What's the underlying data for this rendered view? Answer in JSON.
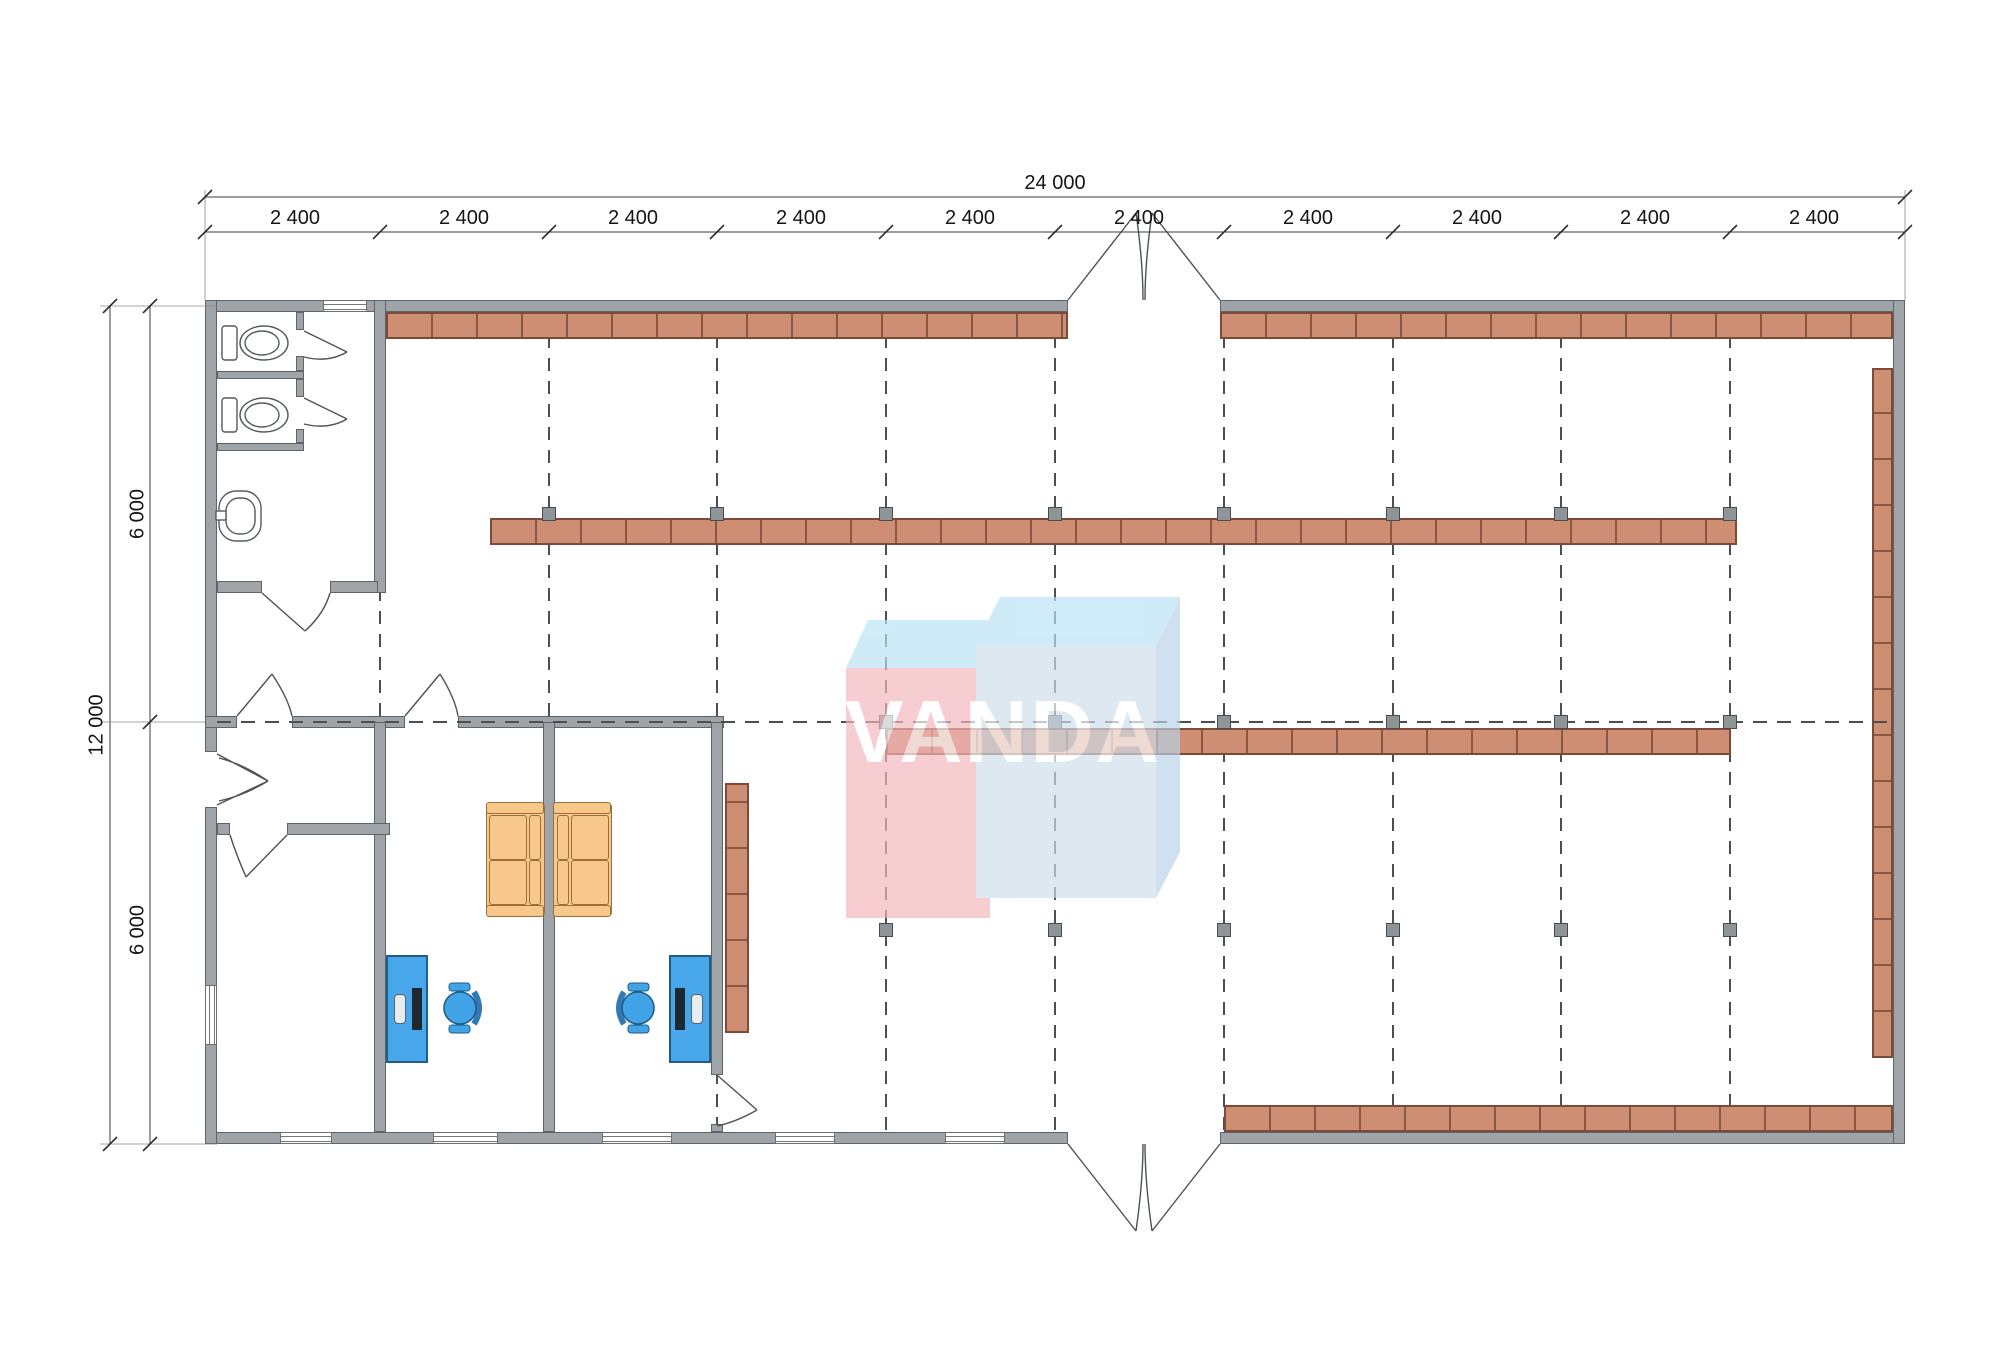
{
  "drawing": {
    "type": "floor-plan",
    "watermark": {
      "text": "VANDA"
    },
    "dimensions": {
      "overall_width_label": "24 000",
      "bay_labels": [
        "2 400",
        "2 400",
        "2 400",
        "2 400",
        "2 400",
        "2 400",
        "2 400",
        "2 400",
        "2 400",
        "2 400"
      ],
      "overall_height_label": "12 000",
      "height_segment_labels": [
        "6 000",
        "6 000"
      ]
    },
    "colors": {
      "wall": "#9EA4A7",
      "wall_edge": "#5F6468",
      "shelf": "#CD8E74",
      "shelf_line": "#7C4A37",
      "column_marker": "#8D9599",
      "grid_dash": "#4A4F52",
      "desk": "#47A7EA",
      "desk_edge": "#1F5E88",
      "chair": "#42A3E6",
      "couch": "#F7C78B",
      "couch_edge": "#9A7036",
      "watermark_pink": "#F3B6BB",
      "watermark_blue": "#CFDEEB",
      "watermark_top": "#B9E3F6",
      "dimension_line": "#3C3C3C"
    }
  }
}
